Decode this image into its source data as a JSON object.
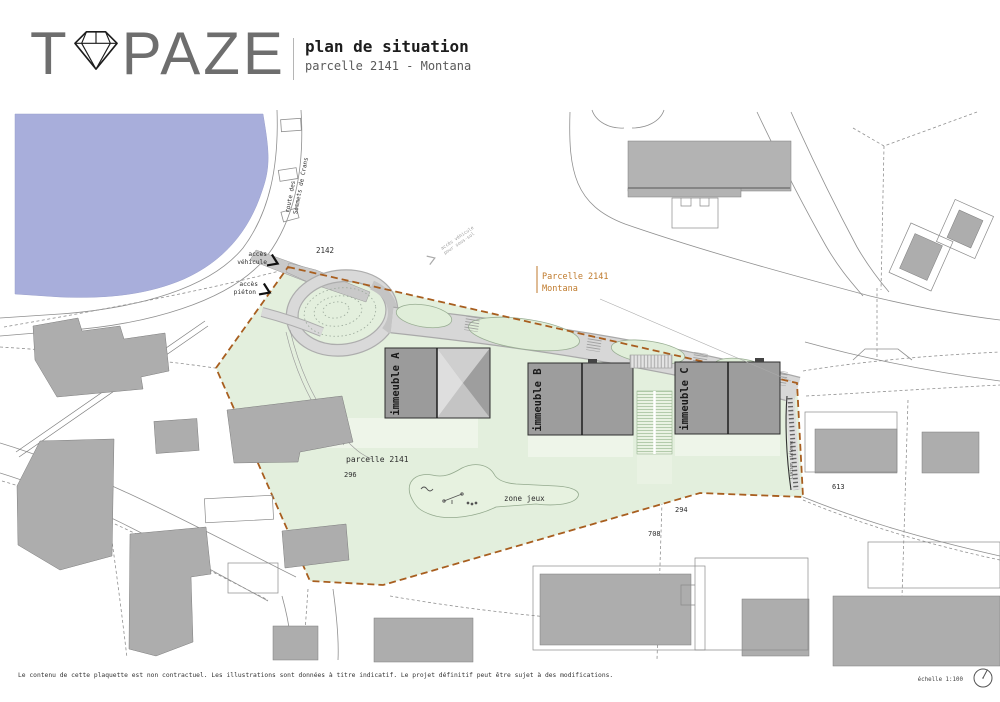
{
  "header": {
    "logo_prefix": "T",
    "logo_suffix": "PAZE",
    "title": "plan de situation",
    "subtitle": "parcelle 2141 - Montana"
  },
  "map": {
    "road_name_line1": "route des",
    "road_name_line2": "Sommets de Crans",
    "access_vehicle_line1": "accès",
    "access_vehicle_line2": "véhicule",
    "access_pedestrian_line1": "accès",
    "access_pedestrian_line2": "piéton",
    "small_note_line1": "accès véhicule",
    "small_note_line2": "pour sous-sol",
    "parcel_callout_line1": "Parcelle 2141",
    "parcel_callout_line2": "Montana",
    "parcel_label": "parcelle 2141",
    "playground_label": "zone jeux",
    "pedestrian_link_label": "liaison piétonne",
    "buildings": {
      "a": "immeuble A",
      "b": "immeuble B",
      "c": "immeuble C"
    },
    "parcel_numbers": {
      "n2142": "2142",
      "n296": "296",
      "n294": "294",
      "n708": "708",
      "n613": "613"
    }
  },
  "footer": {
    "disclaimer": "Le contenu de cette plaquette est non contractuel. Les illustrations sont données à titre indicatif. Le projet définitif peut être sujet à des modifications.",
    "scale": "échelle 1:100"
  },
  "colors": {
    "lake": "#a8aedb",
    "parcel_green": "#e3efdd",
    "parcel_border": "#a85e1f",
    "accent_orange": "#bf7a2c",
    "building_gray": "#9b9b9b"
  }
}
